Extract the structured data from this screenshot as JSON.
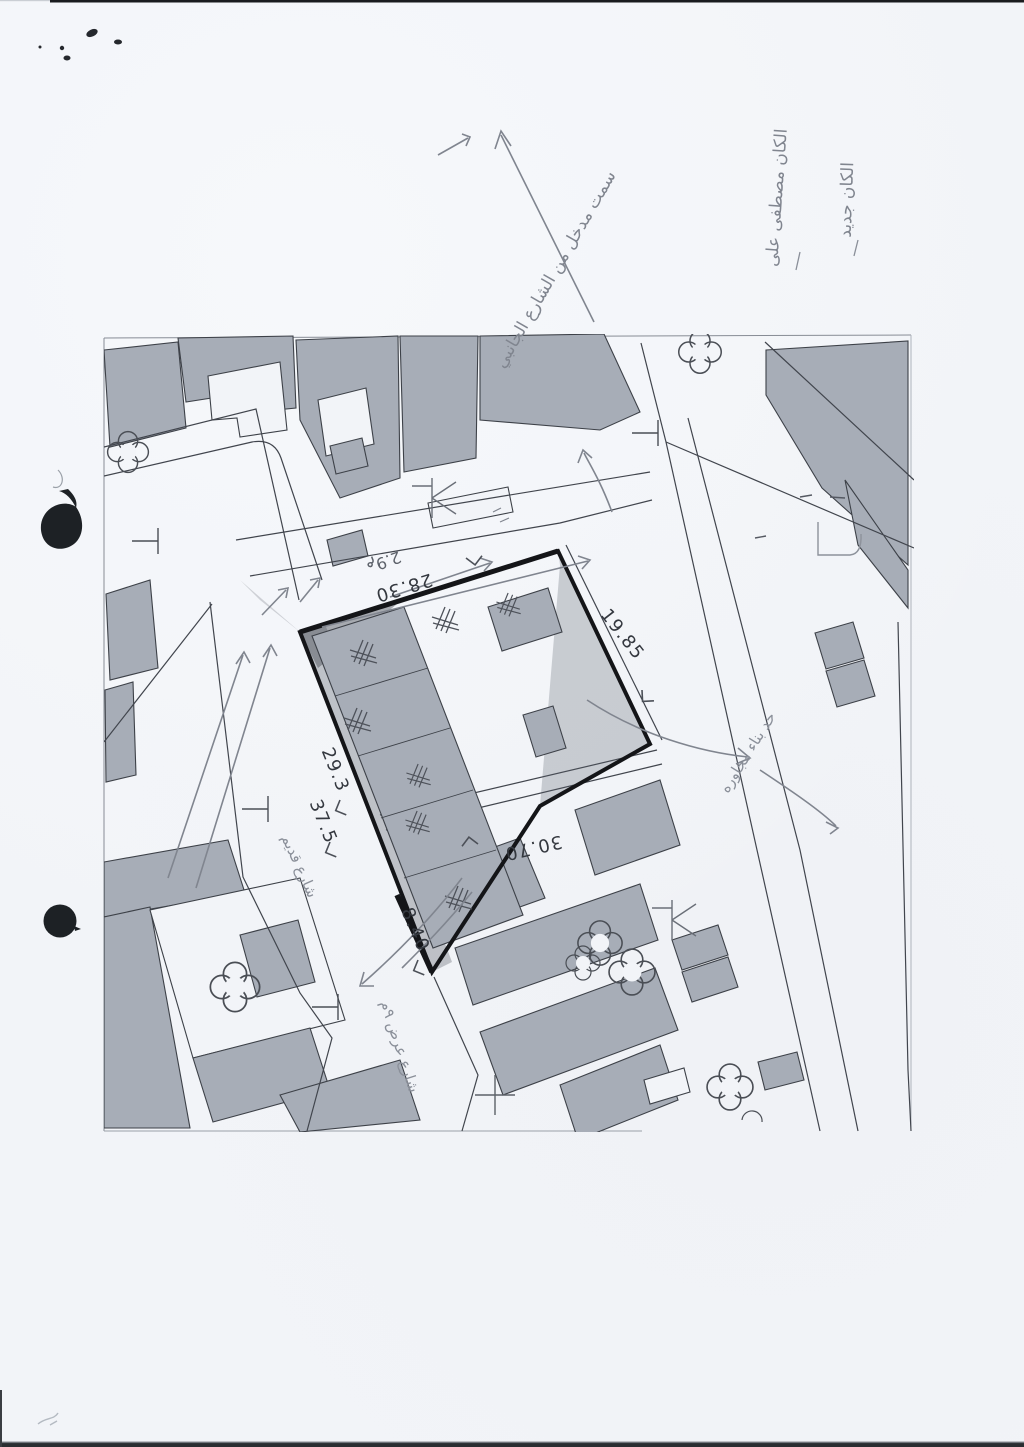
{
  "document_type": "scanned cadastral site-plan sketch",
  "colors": {
    "paper": "#f2f4f8",
    "map_line": "#41454d",
    "building_fill": "#a7adb7",
    "parcel_outline": "#141518",
    "pencil": "#80858f",
    "ink_blot": "#1d2125"
  },
  "measurements": {
    "north": "28.30",
    "northeast": "19.85",
    "southeast": "30.70",
    "southwest": "8.40",
    "west_upper": "29.3",
    "west_lower": "37.5",
    "narrow_width": "2.9م"
  },
  "notes": {
    "top_right_1": "الكان جديد",
    "top_right_2": "الكان مصطفى على",
    "diagonal": "سمت مدخل من الشارع الجانبي",
    "east": "حد بناء مجاوره",
    "west": "شارع قديم",
    "south": "شارع عرض ٩م"
  }
}
